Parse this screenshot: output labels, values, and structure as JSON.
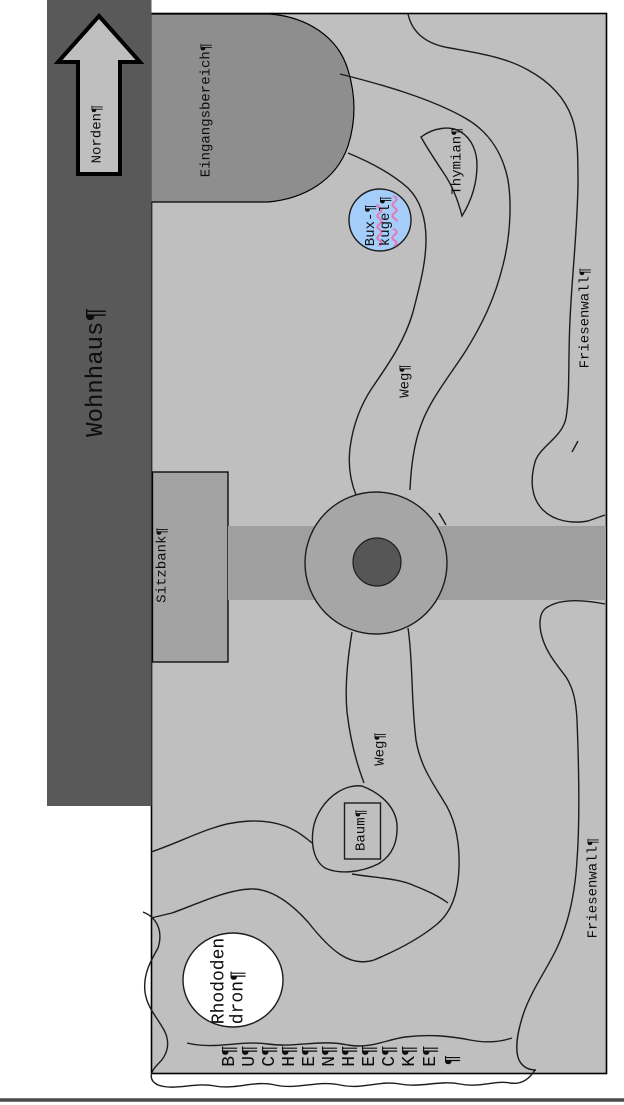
{
  "map_labels": {
    "north": "Norden¶",
    "house": "Wohnhaus¶",
    "entrance": "Eingangsbereich¶",
    "bench": "Sitzbank¶",
    "friesenwall_top": "Friesenwall¶",
    "friesenwall_bottom": "Friesenwall¶",
    "path_top": "Weg¶",
    "path_bottom": "Weg¶",
    "thyme": "Thymian¶",
    "box_ball_line1": "Bux-¶",
    "box_ball_line2": "kugel¶",
    "tree": "Baum¶",
    "rhododendron_line1": "Rhododen",
    "rhododendron_line2": "dron¶"
  },
  "hedge": {
    "letters": [
      "B¶",
      "U¶",
      "C¶",
      "H¶",
      "E¶",
      "N¶",
      "H¶",
      "E¶",
      "C¶",
      "K¶",
      "E¶",
      "¶"
    ]
  },
  "icons": {
    "north_arrow": "up-block-arrow",
    "pilcrow_marks": "formatting-marks-visible"
  },
  "colors": {
    "house_gray": "#595959",
    "plot_gray": "#bfbfbf",
    "paved_gray": "#a3a3a3",
    "entrance_gray": "#8e8e8e",
    "rotary_center_gray": "#565656",
    "box_ball_blue": "#a5cdfa",
    "spellcheck_squiggle": "#e678b4",
    "outline_black": "#1c1c1c",
    "rhododendron_white": "#ffffff"
  }
}
